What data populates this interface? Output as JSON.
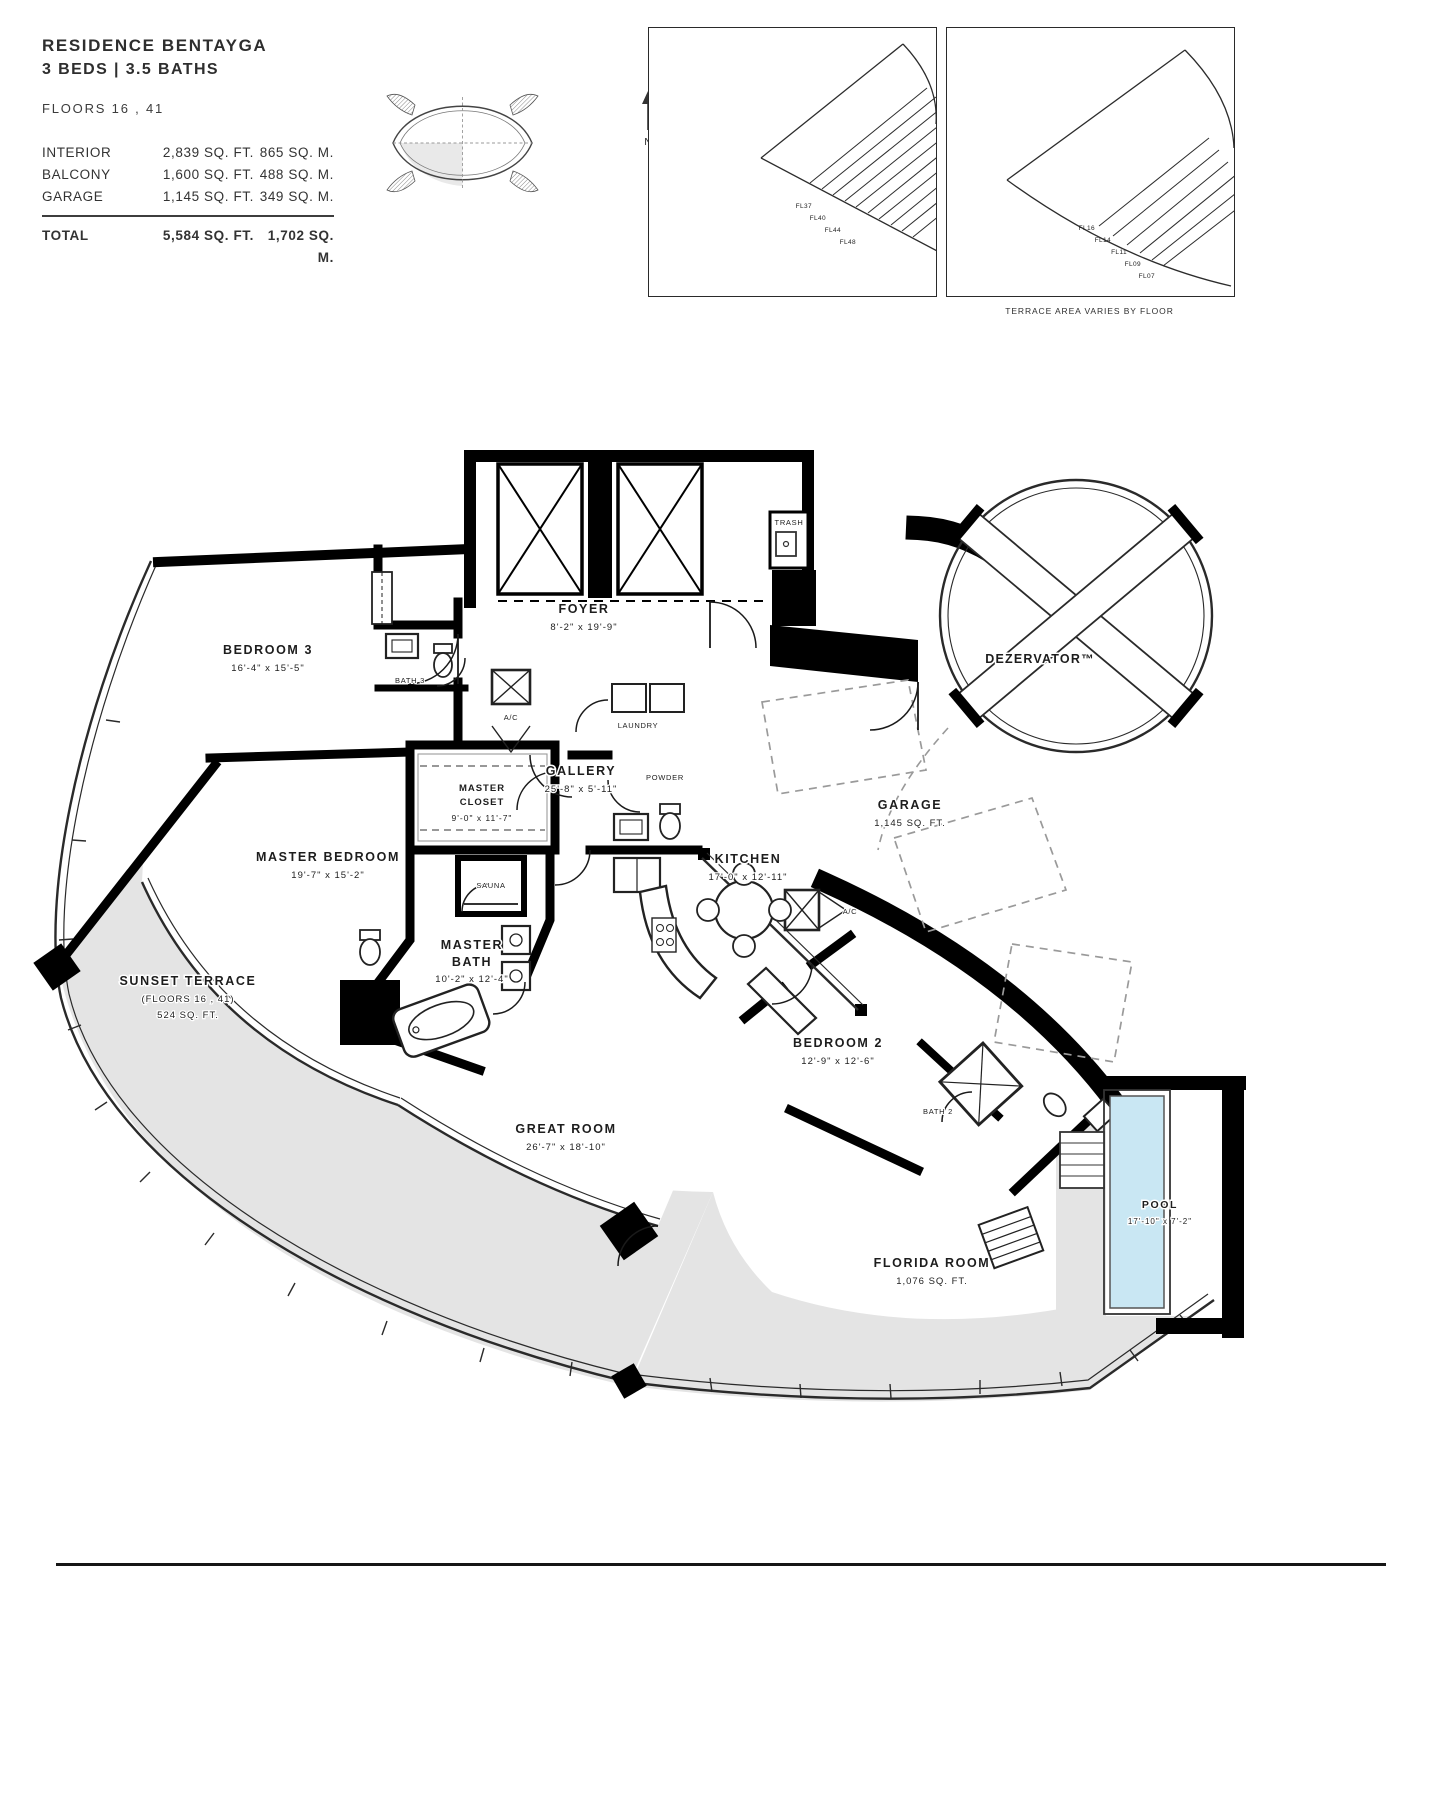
{
  "header": {
    "title": "RESIDENCE BENTAYGA",
    "subtitle": "3 BEDS | 3.5 BATHS",
    "floors_line": "FLOORS 16 , 41",
    "compass": "N",
    "table": {
      "rows": [
        {
          "label": "INTERIOR",
          "sqft": "2,839 SQ. FT.",
          "sqm": "865 SQ. M."
        },
        {
          "label": "BALCONY",
          "sqft": "1,600 SQ. FT.",
          "sqm": "488 SQ. M."
        },
        {
          "label": "GARAGE",
          "sqft": "1,145 SQ. FT.",
          "sqm": "349 SQ. M."
        }
      ],
      "total": {
        "label": "TOTAL",
        "sqft": "5,584 SQ. FT.",
        "sqm": "1,702 SQ. M."
      }
    }
  },
  "keyplans": {
    "left": {
      "labels": [
        "FL37",
        "FL40",
        "FL44",
        "FL48"
      ]
    },
    "right": {
      "labels": [
        "FL16",
        "FL14",
        "FL11",
        "FL09",
        "FL07"
      ]
    },
    "caption": "TERRACE AREA VARIES BY FLOOR"
  },
  "plan": {
    "rooms": {
      "trash": {
        "name": "TRASH"
      },
      "foyer": {
        "name": "FOYER",
        "dims": "8'-2\" x 19'-9\""
      },
      "bedroom3": {
        "name": "BEDROOM 3",
        "dims": "16'-4\" x 15'-5\""
      },
      "bath3": {
        "name": "BATH 3"
      },
      "ac1": {
        "name": "A/C"
      },
      "ac2": {
        "name": "A/C"
      },
      "laundry": {
        "name": "LAUNDRY"
      },
      "powder": {
        "name": "POWDER"
      },
      "gallery": {
        "name": "GALLERY",
        "dims": "25'-8\" x 5'-11\""
      },
      "master_closet": {
        "line1": "MASTER",
        "line2": "CLOSET",
        "dims": "9'-0\" x 11'-7\""
      },
      "master_bedroom": {
        "name": "MASTER BEDROOM",
        "dims": "19'-7\" x 15'-2\""
      },
      "sauna": {
        "name": "SAUNA"
      },
      "master_bath": {
        "line1": "MASTER",
        "line2": "BATH",
        "dims": "10'-2\" x 12'-4\""
      },
      "sunset_terrace": {
        "name": "SUNSET TERRACE",
        "floors": "(FLOORS 16 , 41)",
        "area": "524 SQ. FT."
      },
      "kitchen": {
        "name": "KITCHEN",
        "dims": "17'-0\" x 12'-11\""
      },
      "garage": {
        "name": "GARAGE",
        "area": "1,145 SQ. FT."
      },
      "dezervator": {
        "name": "DEZERVATOR™"
      },
      "bedroom2": {
        "name": "BEDROOM 2",
        "dims": "12'-9\" x 12'-6\""
      },
      "bath2": {
        "name": "BATH 2"
      },
      "great_room": {
        "name": "GREAT ROOM",
        "dims": "26'-7\" x 18'-10\""
      },
      "florida_room": {
        "name": "FLORIDA ROOM",
        "area": "1,076 SQ. FT."
      },
      "pool": {
        "name": "POOL",
        "dims": "17'-10\" x 7'-2\""
      }
    }
  },
  "colors": {
    "wall": "#000000",
    "terrace_gray": "#e4e4e4",
    "pool_water": "#c9e7f3",
    "wave_teal": "#57b7c5"
  }
}
